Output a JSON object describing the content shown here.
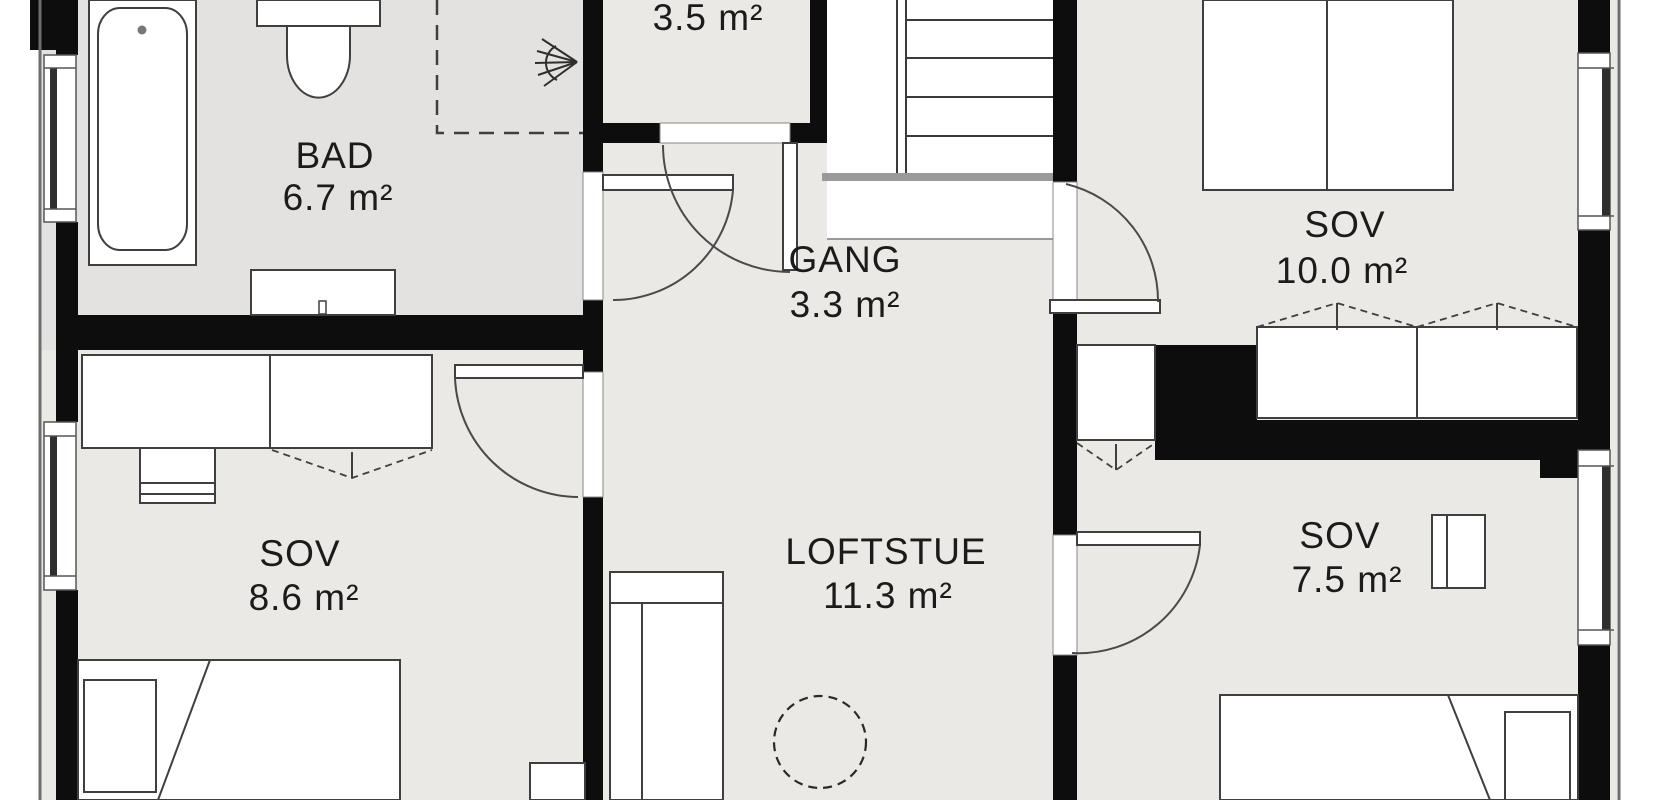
{
  "floorplan": {
    "title": "Loft floor plan",
    "rooms": {
      "bad": {
        "name": "BAD",
        "area": "6.7 m²"
      },
      "storage": {
        "area": "3.5 m²"
      },
      "gang": {
        "name": "GANG",
        "area": "3.3 m²"
      },
      "sov_main": {
        "name": "SOV",
        "area": "10.0 m²"
      },
      "sov_left": {
        "name": "SOV",
        "area": "8.6 m²"
      },
      "loftstue": {
        "name": "LOFTSTUE",
        "area": "11.3 m²"
      },
      "sov_right": {
        "name": "SOV",
        "area": "7.5 m²"
      }
    },
    "furniture": [
      "bathtub",
      "toilet",
      "vanity-sink",
      "shower-head",
      "double-bed",
      "single-bed",
      "wardrobe",
      "closet",
      "desk",
      "chair",
      "sofa",
      "round-table",
      "nightstand",
      "dresser",
      "staircase"
    ],
    "colors": {
      "wall": "#0d0d0d",
      "floor": "#ebe9e5",
      "floor_bath": "#e3e2e0",
      "furniture_fill": "#ffffff",
      "furniture_stroke": "#3f3f3f",
      "thin_line": "#444444",
      "label_text": "#1b1b1b"
    }
  }
}
